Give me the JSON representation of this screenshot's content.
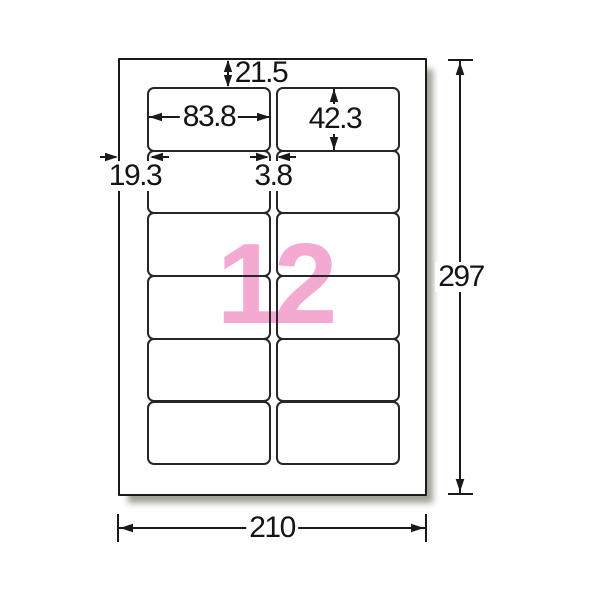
{
  "diagram": {
    "count": "12",
    "grid": {
      "rows": 6,
      "cols": 2
    },
    "colors": {
      "count_pink": "#f4aad0",
      "line": "#1a1a1a"
    },
    "dims": {
      "top_margin": "21.5",
      "label_width": "83.8",
      "label_height": "42.3",
      "left_margin": "19.3",
      "column_gap": "3.8",
      "sheet_height": "297",
      "sheet_width": "210"
    }
  }
}
